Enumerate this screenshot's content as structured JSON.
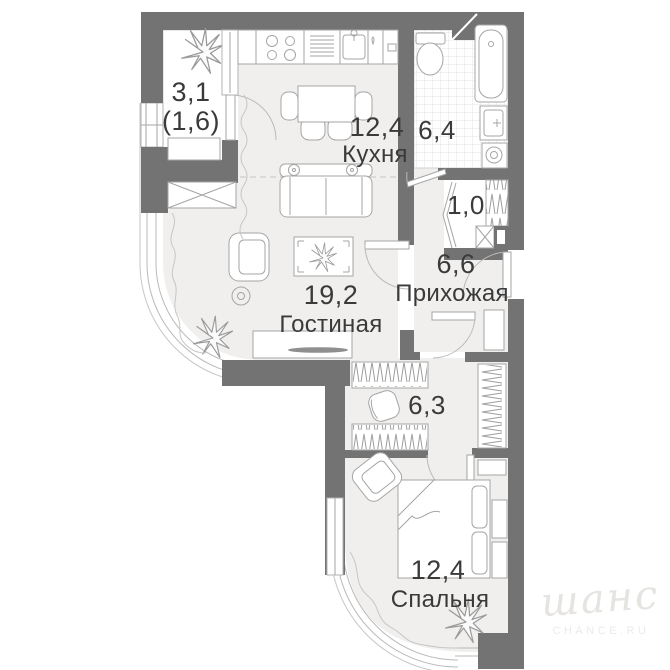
{
  "plan_title": "apartment-floor-plan",
  "rooms": {
    "balcony": {
      "area": "3,1",
      "area_secondary": "(1,6)"
    },
    "kitchen": {
      "area": "12,4",
      "name": "Кухня"
    },
    "bathroom": {
      "area": "6,4"
    },
    "storage": {
      "area": "1,0"
    },
    "hallway": {
      "area": "6,6",
      "name": "Прихожая"
    },
    "living_room": {
      "area": "19,2",
      "name": "Гостиная"
    },
    "corridor": {
      "area": "6,3"
    },
    "bedroom": {
      "area": "12,4",
      "name": "Спальня"
    }
  },
  "watermark": {
    "logo": "шанс",
    "site": "CHANCE.RU"
  },
  "colors": {
    "wall": "#737373",
    "floor": "#f0efed",
    "fixture_line": "#a5a5a5",
    "text": "#3a3a3a",
    "watermark": "#e6e4e1"
  }
}
